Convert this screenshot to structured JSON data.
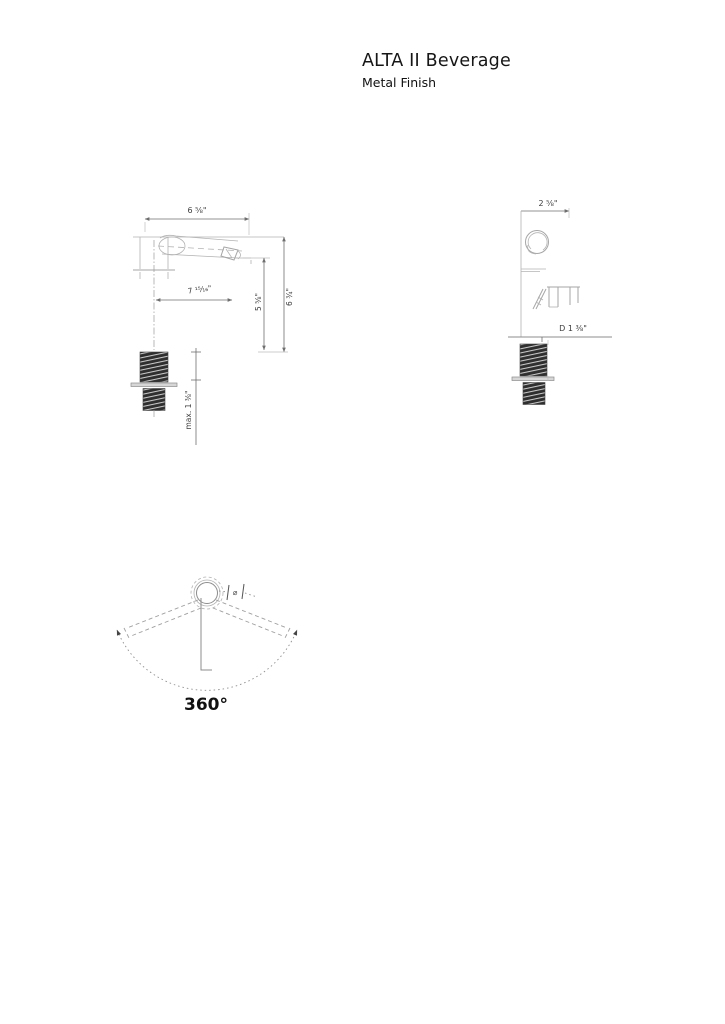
{
  "header": {
    "title": "ALTA II Beverage",
    "subtitle": "Metal Finish"
  },
  "front": {
    "width": "6 ⅝\"",
    "reach": "7 ¹⁵⁄₁₆\"",
    "height_inner": "5 ⅝\"",
    "height_overall": "6 ¾\"",
    "max_thickness": "max. 1 ⅜\""
  },
  "side": {
    "depth": "2 ⅝\"",
    "diameter": "D 1 ⅜\""
  },
  "rotation": {
    "angle": "360°",
    "marker": "⌀"
  },
  "colors": {
    "line_light": "#b3b3b3",
    "line_dim": "#6f6f6f",
    "thread_dark": "#2f2f2f",
    "text": "#161616"
  }
}
